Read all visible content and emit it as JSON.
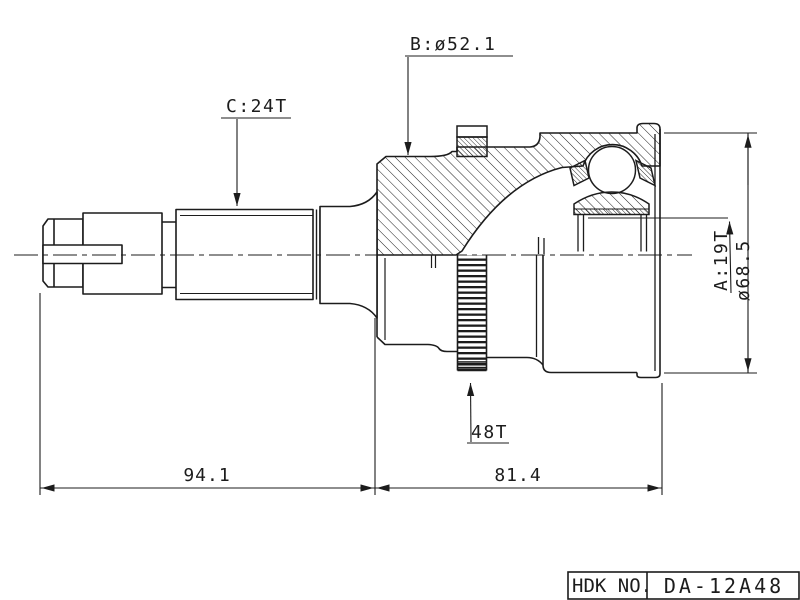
{
  "drawing": {
    "type": "technical-drawing-cv-joint",
    "colors": {
      "line": "#1c1c1c",
      "background": "#ffffff"
    },
    "callouts": {
      "b_diameter": "B:ø52.1",
      "c_spline": "C:24T",
      "a_spline": "A:19T",
      "outer_diameter": "ø68.5",
      "abs_ring_teeth": "48T"
    },
    "dimensions": {
      "shaft_length": "94.1",
      "joint_length": "81.4"
    },
    "title_block": {
      "label": "HDK NO.",
      "part_number": "DA-12A48"
    }
  }
}
